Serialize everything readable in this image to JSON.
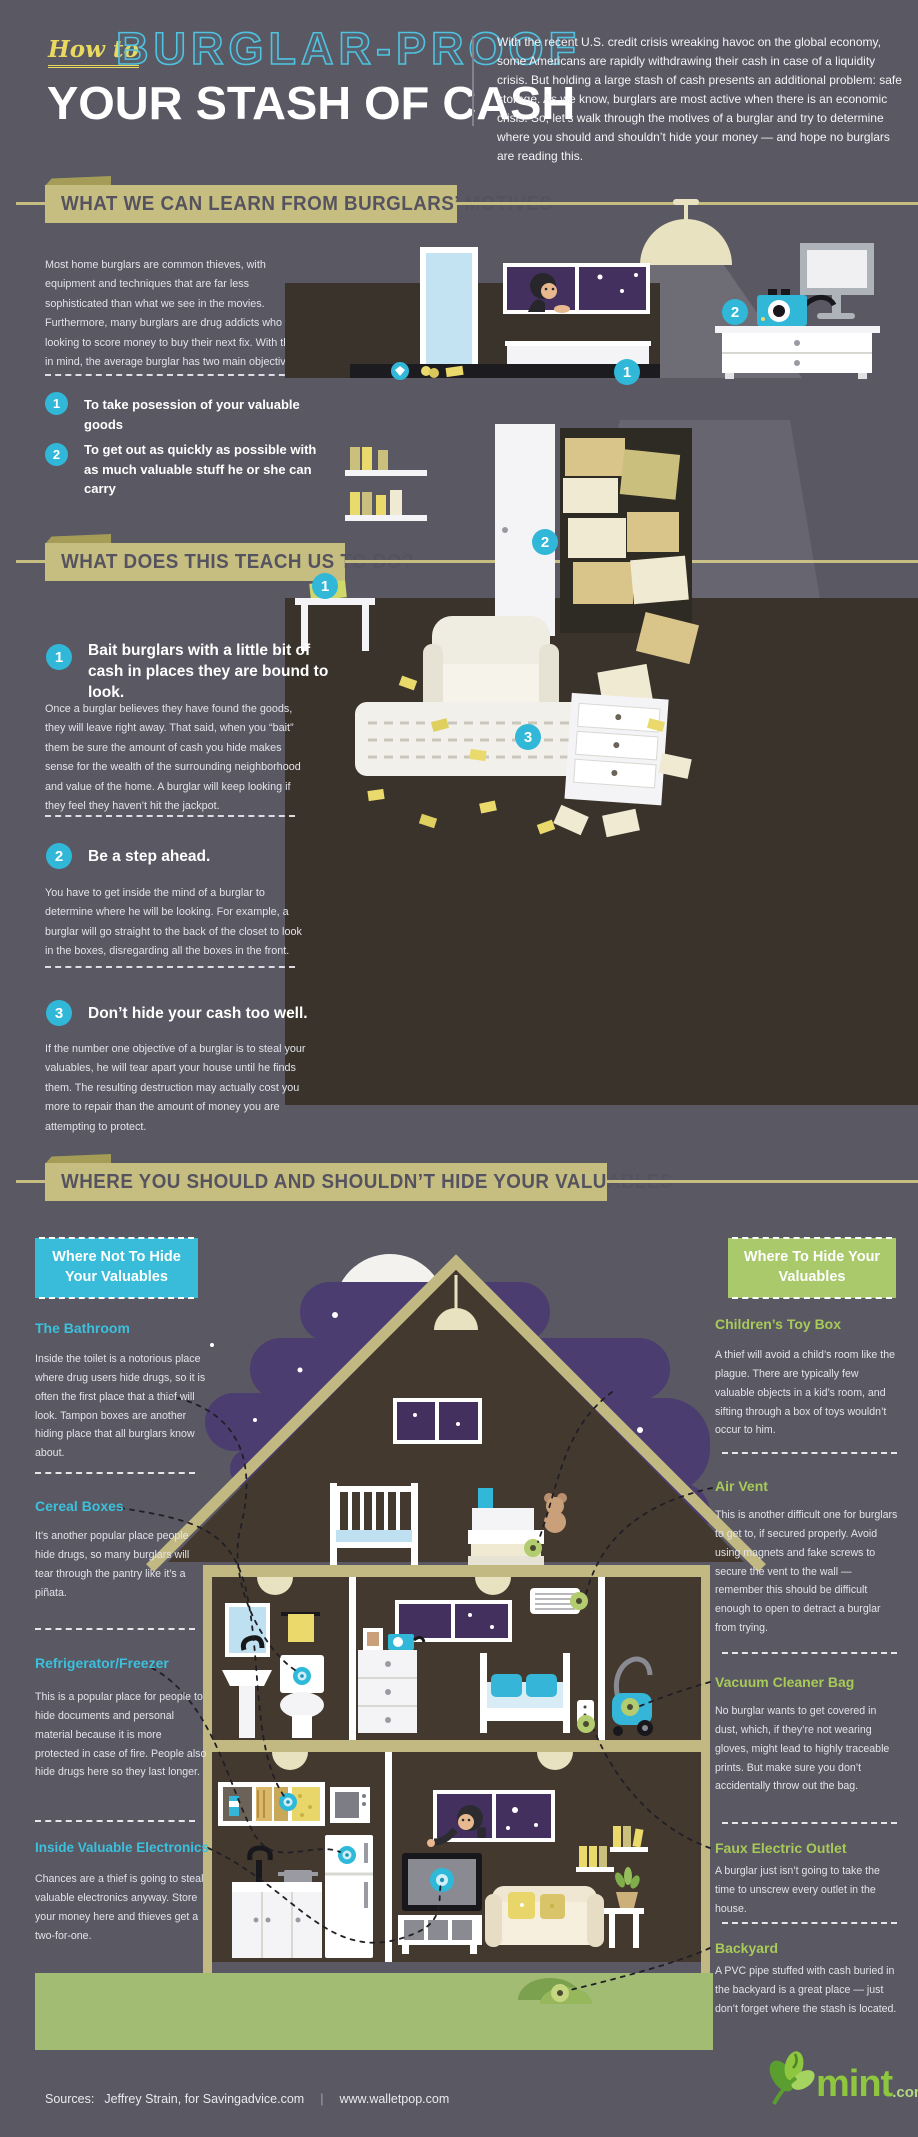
{
  "colors": {
    "background": "#595863",
    "accent_cyan": "#31b7d8",
    "accent_green": "#a9c96b",
    "accent_khaki": "#c6bd80",
    "accent_yellow": "#ead95f",
    "night_purple": "#4c3d70",
    "window_purple": "#44305f",
    "floor_brown": "#443b31",
    "ground_green": "#a2bc74",
    "mint_green": "#8ec73f"
  },
  "header": {
    "kicker": "How to",
    "title1": "BURGLAR-PROOF",
    "title2": "YOUR STASH OF CASH",
    "intro": "With the recent U.S. credit crisis wreaking havoc on the global economy, some Americans are rapidly withdrawing their cash in case of a liquidity crisis. But holding a large stash of cash presents an additional problem: safe storage. As we know, burglars are most active when there is an economic crisis. So, let’s walk through the motives of a burglar and try to determine where you should and shouldn’t hide your money — and hope no burglars are reading this."
  },
  "sections": {
    "motives": {
      "title": "WHAT WE CAN LEARN FROM BURGLARS’ MOTIVES",
      "intro": "Most home burglars are common thieves, with equipment and techniques that are far less sophisticated than what we see in the movies. Furthermore, many burglars are drug addicts who are looking to score money to buy their next fix. With that in mind, the average burglar has two main objectives:",
      "objectives": [
        {
          "num": "1",
          "text": "To take posession of your valuable goods"
        },
        {
          "num": "2",
          "text": "To get out as quickly as possible with as much valuable stuff he or she can carry"
        }
      ]
    },
    "teach": {
      "title": "WHAT DOES THIS TEACH US TO DO?",
      "tips": [
        {
          "num": "1",
          "heading": "Bait burglars with a little bit of cash in places they are bound to look.",
          "body": "Once a burglar believes they have found the goods, they will leave right away. That said, when you “bait” them be sure the amount of cash you hide makes sense for the wealth of the surrounding neighborhood and value of the home. A burglar will keep looking if they feel they haven’t hit the jackpot."
        },
        {
          "num": "2",
          "heading": "Be a step ahead.",
          "body": "You have to get inside the mind of a burglar to determine where he will be looking. For example, a burglar will go straight to the back of the closet to look in the boxes, disregarding all the boxes in the front."
        },
        {
          "num": "3",
          "heading": "Don’t hide your cash too well.",
          "body": "If the number one objective of a burglar is to steal your valuables, he will tear apart your house until he finds them. The resulting destruction may actually cost you more to repair than the amount of money you are attempting to protect."
        }
      ]
    },
    "where": {
      "title": "WHERE YOU SHOULD AND SHOULDN’T HIDE YOUR VALUABLES",
      "not_box": "Where Not To Hide Your Valuables",
      "hide_box": "Where To Hide Your Valuables",
      "not_items": [
        {
          "heading": "The Bathroom",
          "body": "Inside the toilet is a notorious place where drug users hide drugs, so it is often the first place that a thief will look. Tampon boxes are another hiding place that all burglars know about."
        },
        {
          "heading": "Cereal Boxes",
          "body": "It’s another popular place people hide drugs, so many burglars will tear through the pantry like it’s a piñata."
        },
        {
          "heading": "Refrigerator/Freezer",
          "body": "This is a popular place for people to hide documents and personal material because it is more protected in case of fire. People also hide drugs here so they last longer."
        },
        {
          "heading": "Inside Valuable Electronics",
          "body": "Chances are a thief is going to steal valuable electronics anyway. Store your money here and thieves get a two-for-one."
        }
      ],
      "hide_items": [
        {
          "heading": "Children’s Toy Box",
          "body": "A thief will avoid a child’s room like the plague. There are typically few valuable objects in a kid’s room, and sifting through a box of toys wouldn’t occur to him."
        },
        {
          "heading": "Air Vent",
          "body": "This is another difficult one for burglars to get to, if secured properly. Avoid using magnets and fake screws to secure the vent to the wall — remember this should be difficult enough to open to detract a burglar from trying."
        },
        {
          "heading": "Vacuum Cleaner Bag",
          "body": "No burglar wants to get covered in dust, which, if they’re not wearing gloves, might lead to highly traceable prints. But make sure you don’t accidentally throw out the bag."
        },
        {
          "heading": "Faux Electric Outlet",
          "body": "A burglar just isn’t going to take the time to unscrew every outlet in the house."
        },
        {
          "heading": "Backyard",
          "body": "A PVC pipe stuffed with cash buried in the backyard is a great place — just don’t forget where the stash is located."
        }
      ]
    }
  },
  "illustrations": {
    "room_markers": [
      "1",
      "2"
    ],
    "search_markers": [
      "1",
      "2",
      "3"
    ]
  },
  "footer": {
    "sources_label": "Sources:",
    "source1": "Jeffrey Strain, for Savingadvice.com",
    "separator": "|",
    "source2": "www.walletpop.com",
    "brand": "mint",
    "brand_suffix": ".com"
  }
}
